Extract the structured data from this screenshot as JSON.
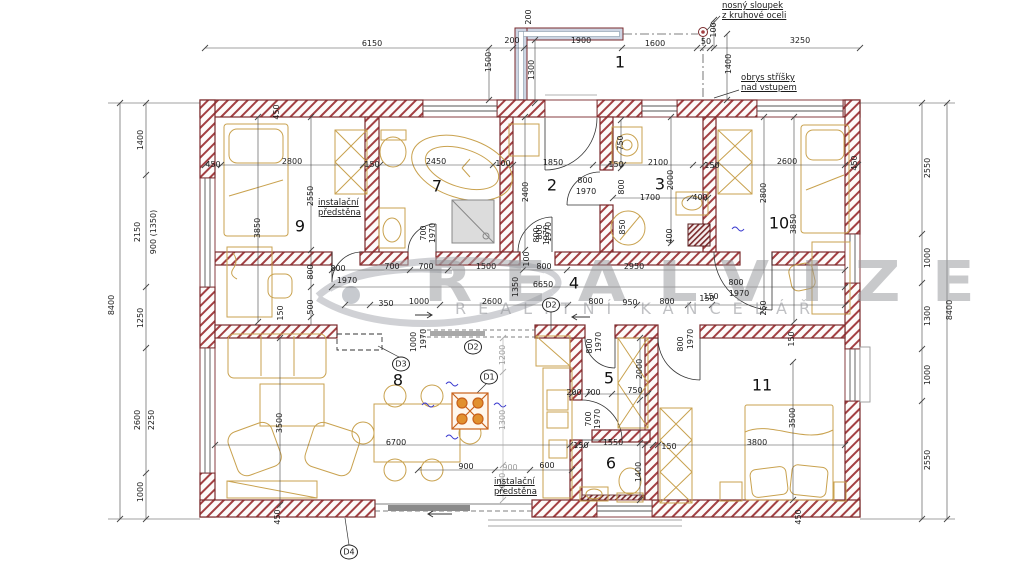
{
  "watermark": {
    "brand": "REALVIZE",
    "subtitle": "REALITNÍ KANCELÁŘ",
    "color": "#96989c"
  },
  "colors": {
    "wall_outline": "#7a2a2c",
    "wall_hatch": "#a34043",
    "furniture": "#c9a24f",
    "dimension": "#1c1c1c",
    "dimension_gray": "#9a9a9a",
    "fireplace": "#c8611a",
    "vent_mark_blue": "#3d3dd0",
    "canopy": "#cdd5e3"
  },
  "rooms": [
    {
      "number": "1",
      "x": 620,
      "y": 63
    },
    {
      "number": "2",
      "x": 552,
      "y": 186
    },
    {
      "number": "3",
      "x": 660,
      "y": 185
    },
    {
      "number": "4",
      "x": 574,
      "y": 284
    },
    {
      "number": "5",
      "x": 609,
      "y": 379
    },
    {
      "number": "6",
      "x": 611,
      "y": 464
    },
    {
      "number": "7",
      "x": 437,
      "y": 187
    },
    {
      "number": "8",
      "x": 398,
      "y": 381
    },
    {
      "number": "9",
      "x": 300,
      "y": 227
    },
    {
      "number": "10",
      "x": 779,
      "y": 224
    },
    {
      "number": "11",
      "x": 762,
      "y": 386
    }
  ],
  "door_tags": [
    {
      "t": "D1",
      "x": 489,
      "y": 377
    },
    {
      "t": "D2",
      "x": 551,
      "y": 305
    },
    {
      "t": "D2",
      "x": 473,
      "y": 347
    },
    {
      "t": "D3",
      "x": 401,
      "y": 364
    },
    {
      "t": "D4",
      "x": 349,
      "y": 552
    }
  ],
  "notes": [
    {
      "t": "nosný sloupek\nz kruhové oceli",
      "x": 722,
      "y": 2
    },
    {
      "t": "obrys stříšky\nnad vstupem",
      "x": 741,
      "y": 74
    },
    {
      "t": "instalační\npředstěna",
      "x": 318,
      "y": 199
    },
    {
      "t": "instalační\npředstěna",
      "x": 494,
      "y": 478
    }
  ],
  "dims": [
    {
      "t": "6150",
      "x": 372,
      "y": 44
    },
    {
      "t": "200",
      "x": 512,
      "y": 41
    },
    {
      "t": "1900",
      "x": 581,
      "y": 41
    },
    {
      "t": "1600",
      "x": 655,
      "y": 44
    },
    {
      "t": "3250",
      "x": 800,
      "y": 41
    },
    {
      "t": "1500",
      "x": 489,
      "y": 62,
      "r": -90
    },
    {
      "t": "200",
      "x": 529,
      "y": 17,
      "r": -90
    },
    {
      "t": "1300",
      "x": 532,
      "y": 70,
      "r": -90
    },
    {
      "t": "100",
      "x": 714,
      "y": 30,
      "r": -90
    },
    {
      "t": "50",
      "x": 706,
      "y": 42
    },
    {
      "t": "1400",
      "x": 729,
      "y": 64,
      "r": -90
    },
    {
      "t": "8400",
      "x": 112,
      "y": 305,
      "r": -90
    },
    {
      "t": "1400",
      "x": 141,
      "y": 140,
      "r": -90
    },
    {
      "t": "2150",
      "x": 138,
      "y": 232,
      "r": -90
    },
    {
      "t": "900 (1350)",
      "x": 154,
      "y": 232,
      "r": -90
    },
    {
      "t": "1250",
      "x": 141,
      "y": 318,
      "r": -90
    },
    {
      "t": "2600",
      "x": 138,
      "y": 420,
      "r": -90
    },
    {
      "t": "2250",
      "x": 152,
      "y": 420,
      "r": -90
    },
    {
      "t": "1000",
      "x": 141,
      "y": 492,
      "r": -90
    },
    {
      "t": "2550",
      "x": 928,
      "y": 168,
      "r": -90
    },
    {
      "t": "1000",
      "x": 928,
      "y": 258,
      "r": -90
    },
    {
      "t": "1300",
      "x": 928,
      "y": 316,
      "r": -90
    },
    {
      "t": "8400",
      "x": 950,
      "y": 310,
      "r": -90
    },
    {
      "t": "1000",
      "x": 928,
      "y": 375,
      "r": -90
    },
    {
      "t": "2550",
      "x": 928,
      "y": 460,
      "r": -90
    },
    {
      "t": "450",
      "x": 213,
      "y": 165
    },
    {
      "t": "2800",
      "x": 292,
      "y": 162
    },
    {
      "t": "150",
      "x": 372,
      "y": 165
    },
    {
      "t": "2450",
      "x": 436,
      "y": 162
    },
    {
      "t": "100",
      "x": 503,
      "y": 164
    },
    {
      "t": "1850",
      "x": 553,
      "y": 163
    },
    {
      "t": "150",
      "x": 616,
      "y": 165
    },
    {
      "t": "2100",
      "x": 658,
      "y": 163
    },
    {
      "t": "150",
      "x": 712,
      "y": 166
    },
    {
      "t": "2600",
      "x": 787,
      "y": 162
    },
    {
      "t": "450",
      "x": 855,
      "y": 163,
      "r": -90
    },
    {
      "t": "450",
      "x": 277,
      "y": 112,
      "r": -90
    },
    {
      "t": "2550",
      "x": 311,
      "y": 196,
      "r": -90
    },
    {
      "t": "3850",
      "x": 258,
      "y": 228,
      "r": -90
    },
    {
      "t": "800",
      "x": 311,
      "y": 272,
      "r": -90
    },
    {
      "t": "500",
      "x": 311,
      "y": 307,
      "r": -90
    },
    {
      "t": "150",
      "x": 281,
      "y": 313,
      "r": -90
    },
    {
      "t": "800",
      "x": 338,
      "y": 269
    },
    {
      "t": "1970",
      "x": 347,
      "y": 281
    },
    {
      "t": "700",
      "x": 424,
      "y": 233,
      "r": -90
    },
    {
      "t": "1970",
      "x": 433,
      "y": 233,
      "r": -90
    },
    {
      "t": "2400",
      "x": 526,
      "y": 192,
      "r": -90
    },
    {
      "t": "800",
      "x": 540,
      "y": 232,
      "r": -90
    },
    {
      "t": "1970",
      "x": 549,
      "y": 232,
      "r": -90
    },
    {
      "t": "800",
      "x": 585,
      "y": 181
    },
    {
      "t": "1970",
      "x": 586,
      "y": 192
    },
    {
      "t": "800",
      "x": 537,
      "y": 235,
      "r": -90
    },
    {
      "t": "1970",
      "x": 547,
      "y": 235,
      "r": -90
    },
    {
      "t": "750",
      "x": 621,
      "y": 143,
      "r": -90
    },
    {
      "t": "800",
      "x": 622,
      "y": 187,
      "r": -90
    },
    {
      "t": "2000",
      "x": 671,
      "y": 180,
      "r": -90
    },
    {
      "t": "1700",
      "x": 650,
      "y": 198
    },
    {
      "t": "850",
      "x": 623,
      "y": 227,
      "r": -90
    },
    {
      "t": "400",
      "x": 670,
      "y": 236,
      "r": -90
    },
    {
      "t": "400",
      "x": 700,
      "y": 198
    },
    {
      "t": "2800",
      "x": 764,
      "y": 193,
      "r": -90
    },
    {
      "t": "800",
      "x": 736,
      "y": 283
    },
    {
      "t": "1970",
      "x": 739,
      "y": 294
    },
    {
      "t": "150",
      "x": 711,
      "y": 297
    },
    {
      "t": "250",
      "x": 764,
      "y": 308,
      "r": -90
    },
    {
      "t": "3850",
      "x": 794,
      "y": 224,
      "r": -90
    },
    {
      "t": "700",
      "x": 392,
      "y": 267
    },
    {
      "t": "700",
      "x": 426,
      "y": 267
    },
    {
      "t": "1500",
      "x": 486,
      "y": 267
    },
    {
      "t": "800",
      "x": 544,
      "y": 267
    },
    {
      "t": "2950",
      "x": 634,
      "y": 267
    },
    {
      "t": "100",
      "x": 527,
      "y": 259,
      "r": -90
    },
    {
      "t": "6650",
      "x": 543,
      "y": 285
    },
    {
      "t": "1350",
      "x": 516,
      "y": 287,
      "r": -90
    },
    {
      "t": "350",
      "x": 386,
      "y": 304
    },
    {
      "t": "1000",
      "x": 419,
      "y": 302
    },
    {
      "t": "2600",
      "x": 492,
      "y": 302
    },
    {
      "t": "800",
      "x": 596,
      "y": 302
    },
    {
      "t": "950",
      "x": 630,
      "y": 303
    },
    {
      "t": "800",
      "x": 667,
      "y": 302
    },
    {
      "t": "150",
      "x": 707,
      "y": 299
    },
    {
      "t": "1000",
      "x": 414,
      "y": 342,
      "r": -90
    },
    {
      "t": "1970",
      "x": 424,
      "y": 339,
      "r": -90
    },
    {
      "t": "3500",
      "x": 280,
      "y": 423,
      "r": -90
    },
    {
      "t": "6700",
      "x": 396,
      "y": 443
    },
    {
      "t": "450",
      "x": 278,
      "y": 517,
      "r": -90
    },
    {
      "t": "1200",
      "x": 503,
      "y": 355,
      "r": -90,
      "k": "g"
    },
    {
      "t": "1300",
      "x": 503,
      "y": 420,
      "r": -90,
      "k": "g"
    },
    {
      "t": "1000",
      "x": 503,
      "y": 483,
      "r": -90,
      "k": "g"
    },
    {
      "t": "900",
      "x": 466,
      "y": 467
    },
    {
      "t": "900",
      "x": 510,
      "y": 468,
      "k": "g"
    },
    {
      "t": "600",
      "x": 547,
      "y": 466
    },
    {
      "t": "800",
      "x": 590,
      "y": 346,
      "r": -90
    },
    {
      "t": "1970",
      "x": 599,
      "y": 342,
      "r": -90
    },
    {
      "t": "2000",
      "x": 640,
      "y": 369,
      "r": -90
    },
    {
      "t": "200",
      "x": 574,
      "y": 393
    },
    {
      "t": "700",
      "x": 593,
      "y": 393
    },
    {
      "t": "750",
      "x": 635,
      "y": 391
    },
    {
      "t": "700",
      "x": 589,
      "y": 419,
      "r": -90
    },
    {
      "t": "1970",
      "x": 598,
      "y": 419,
      "r": -90
    },
    {
      "t": "150",
      "x": 581,
      "y": 446
    },
    {
      "t": "1550",
      "x": 613,
      "y": 443
    },
    {
      "t": "1400",
      "x": 639,
      "y": 472,
      "r": -90
    },
    {
      "t": "150",
      "x": 669,
      "y": 447
    },
    {
      "t": "800",
      "x": 681,
      "y": 344,
      "r": -90
    },
    {
      "t": "1970",
      "x": 691,
      "y": 339,
      "r": -90
    },
    {
      "t": "150",
      "x": 792,
      "y": 339,
      "r": -90
    },
    {
      "t": "3800",
      "x": 757,
      "y": 443
    },
    {
      "t": "3500",
      "x": 793,
      "y": 418,
      "r": -90
    },
    {
      "t": "450",
      "x": 799,
      "y": 517,
      "r": -90
    }
  ]
}
